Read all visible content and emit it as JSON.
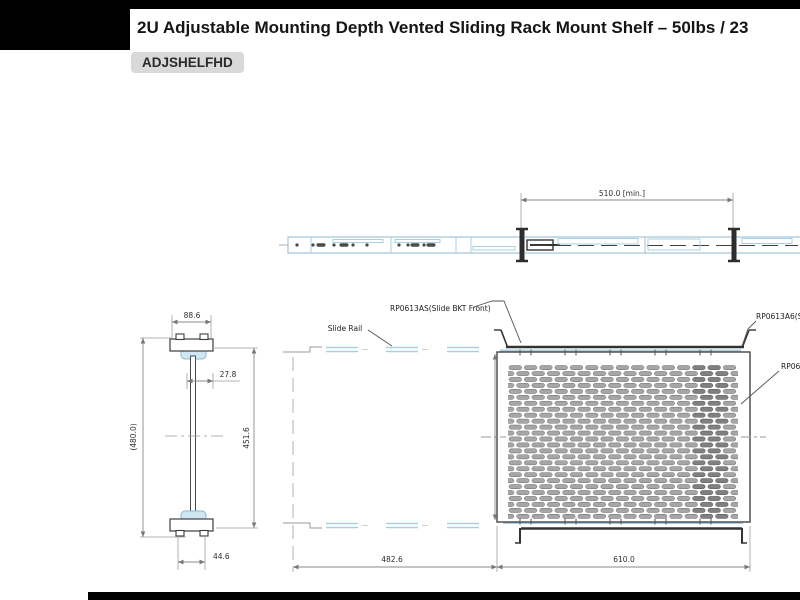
{
  "page": {
    "title": "2U Adjustable Mounting Depth Vented Sliding Rack Mount Shelf – 50lbs / 23",
    "part_number": "ADJSHELFHD"
  },
  "drawing": {
    "dimensions": {
      "rail_min_extension": "510.0 [min.]",
      "bracket_width": "88.6",
      "rail_offset": "27.8",
      "overall_depth": "(480.0)",
      "inner_depth": "451.6",
      "foot_width": "44.6",
      "rail_span": "482.6",
      "shelf_width": "610.0"
    },
    "labels": {
      "slide_rail": "Slide Rail",
      "slide_bkt_front": "RP0613AS(Slide BKT Front)",
      "slide_bkt_rear": "RP0613A6(Sli",
      "shelf_part": "RP061"
    },
    "vent_pattern": {
      "rows": 26,
      "cols": 15
    },
    "colors": {
      "rail_blue": "#a8d2e4",
      "line_dark": "#3c3c3c",
      "dim_gray": "#8a8a8a",
      "slot_fill": "#a6a6a6",
      "slot_dark": "#808080",
      "badge_bg": "#d9d9d9"
    }
  }
}
